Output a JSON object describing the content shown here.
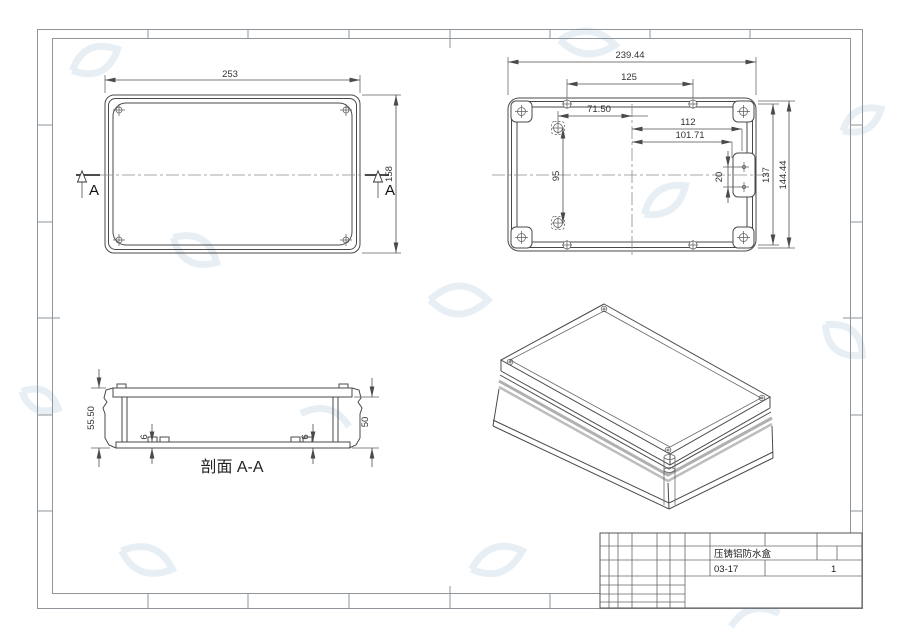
{
  "front_view": {
    "width_dim": "253",
    "height_dim": "158",
    "section_marker_left": "A",
    "section_marker_right": "A"
  },
  "back_view": {
    "overall_width_dim": "239.44",
    "screw_span_dim": "125",
    "boss_offset_dim": "71.50",
    "tab_offset_dim1": "112",
    "tab_offset_dim2": "101.71",
    "boss_span_dim": "95",
    "tab_hole_span_dim": "20",
    "screw_height_dim": "137",
    "inner_height_dim": "144.44"
  },
  "section_view": {
    "caption": "剖面 A-A",
    "overall_height_dim": "55.50",
    "inner_height_dim": "50",
    "floor_thickness_dim_left": "6",
    "floor_thickness_dim_right": "6"
  },
  "title_block": {
    "part_name": "压铸铝防水盒",
    "drawing_code": "03-17",
    "sheet_number": "1"
  }
}
